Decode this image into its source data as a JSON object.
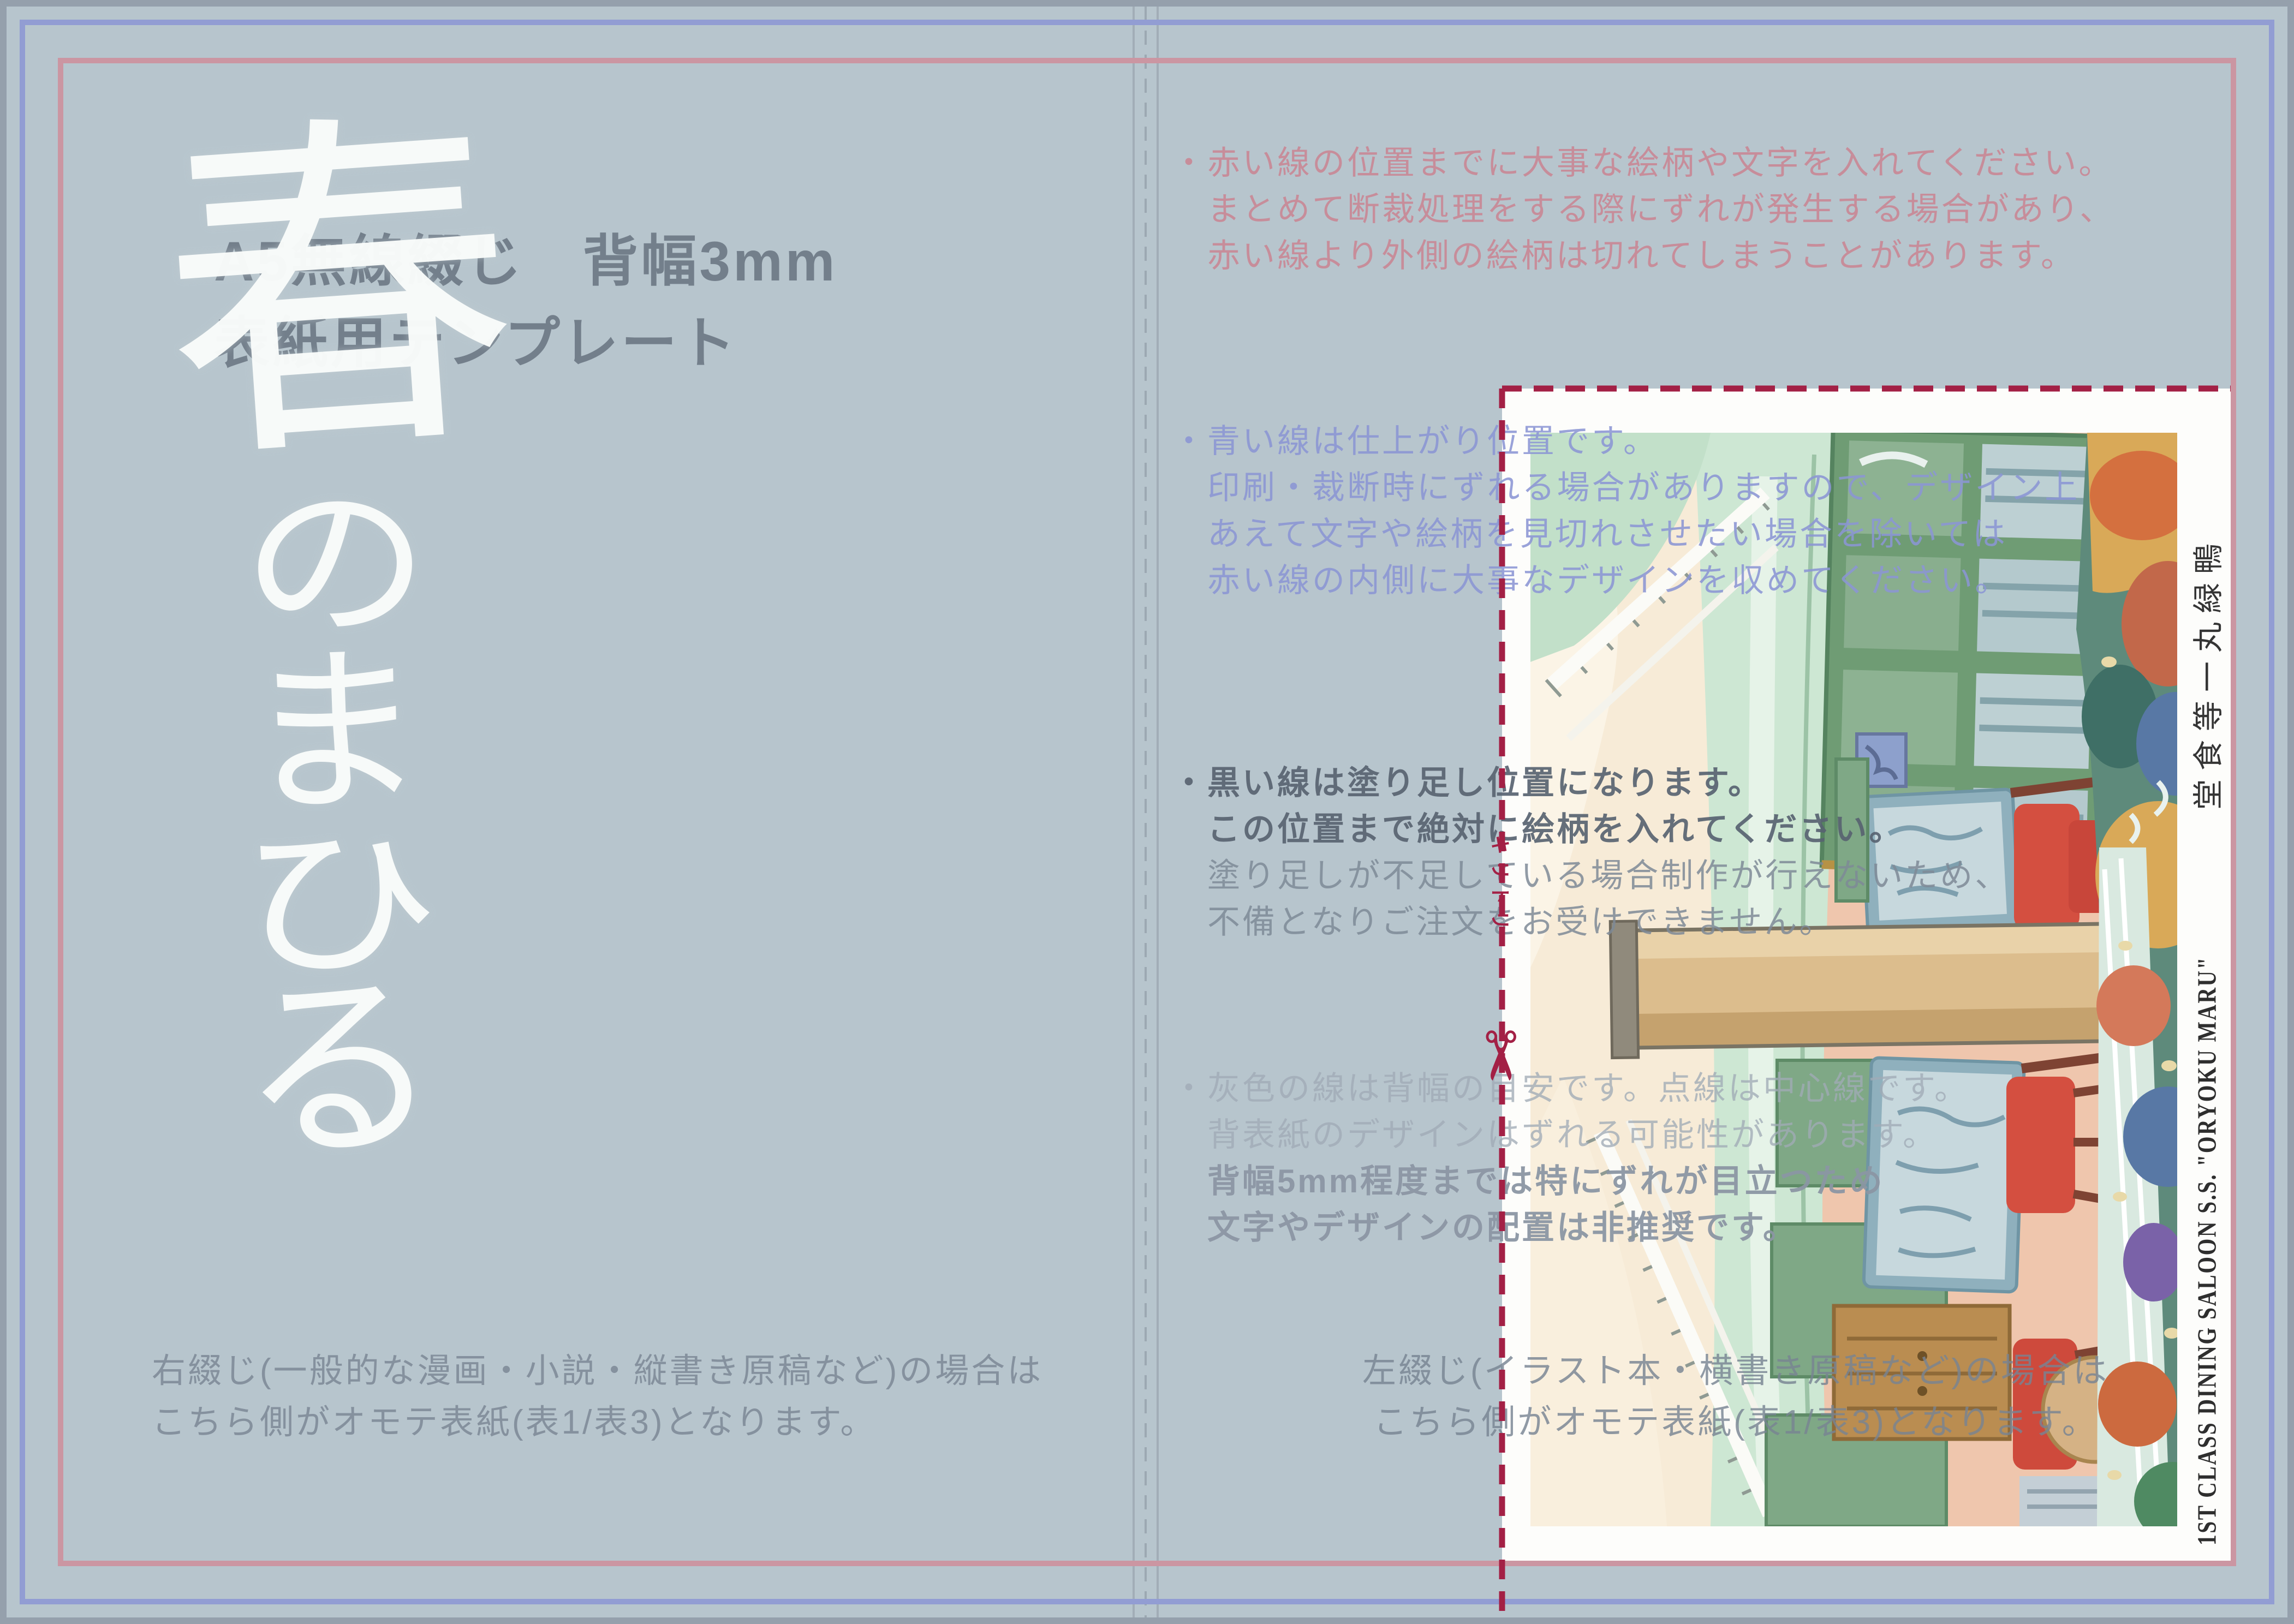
{
  "template": {
    "title_line1": "A5無線綴じ　背幅3mm",
    "title_line2": "表紙用テンプレート",
    "cover_title": "春のまひる",
    "calligraphy_chars": [
      "春",
      "の",
      "ま",
      "ひ",
      "る"
    ]
  },
  "notes": {
    "red": {
      "lines": [
        "・赤い線の位置までに大事な絵柄や文字を入れてください。",
        "まとめて断裁処理をする際にずれが発生する場合があり、",
        "赤い線より外側の絵柄は切れてしまうことがあります。"
      ]
    },
    "blue": {
      "lines": [
        "・青い線は仕上がり位置です。",
        "印刷・裁断時にずれる場合がありますので、デザイン上",
        "あえて文字や絵柄を見切れさせたい場合を除いては",
        "赤い線の内側に大事なデザインを収めてください。"
      ]
    },
    "black": {
      "lines": [
        "・黒い線は塗り足し位置になります。",
        "この位置まで絶対に絵柄を入れてください。",
        "塗り足しが不足している場合制作が行えないため、",
        "不備となりご注文をお受けできません。"
      ]
    },
    "gray": {
      "lines": [
        "・灰色の線は背幅の目安です。点線は中心線です。",
        "背表紙のデザインはずれる可能性があります。",
        "背幅5mm程度までは特にずれが目立つため",
        "文字やデザインの配置は非推奨です。"
      ]
    }
  },
  "footer": {
    "left_line1": "右綴じ(一般的な漫画・小説・縦書き原稿など)の場合は",
    "left_line2": "こちら側がオモテ表紙(表1/表3)となります。",
    "right_line1": "左綴じ(イラスト本・横書き原稿など)の場合は",
    "right_line2": "こちら側がオモテ表紙(表1/表3)となります。"
  },
  "cut": {
    "label": "キリトリ",
    "scissors_icon": "✂"
  },
  "postcard": {
    "caption_en": "1ST CLASS DINING SALOON S.S. \"ORYOKU MARU\"",
    "caption_ja_display": "堂食等一丸緑鴨"
  },
  "colors": {
    "canvas": "#b7c5cd",
    "page_border": "#95a0ac",
    "finish_line_blue": "#929dd3",
    "safety_line_red": "#cb96a2",
    "cut_mark_crimson": "#a32045",
    "spine_guide_gray": "#a2adb7",
    "title_gray": "#6c7886",
    "calligraphy_white": "#fafcfb",
    "postcard_white": "#fdfdfb"
  }
}
